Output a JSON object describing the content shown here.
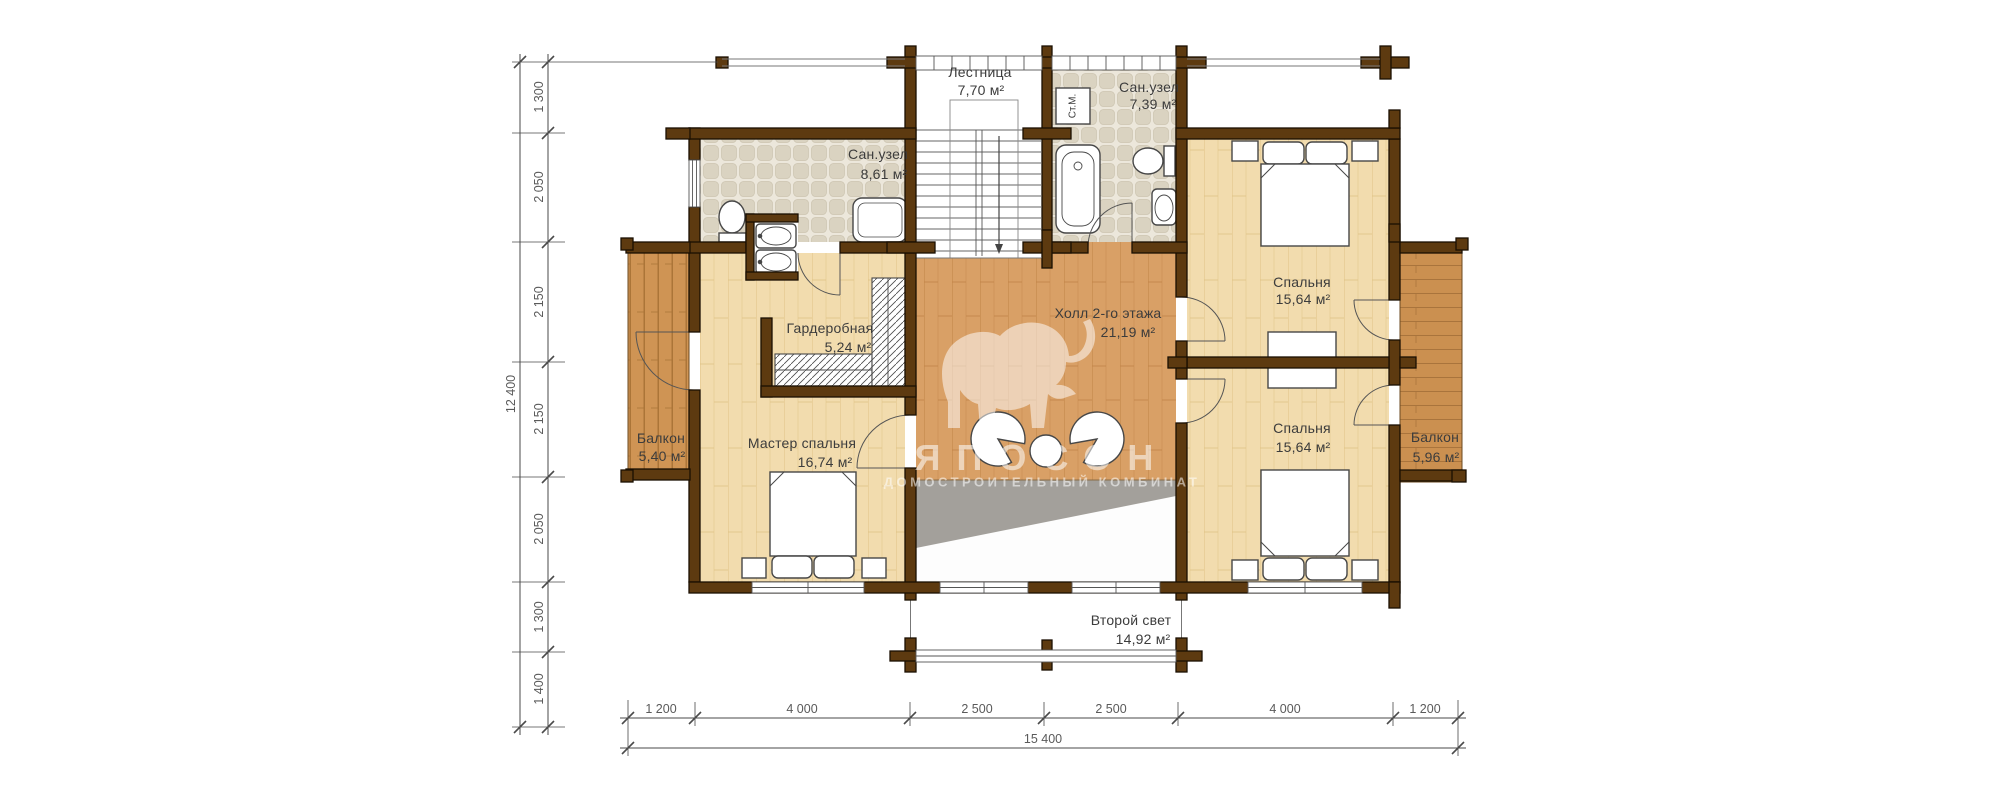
{
  "watermark": {
    "title": "ЯПОСОН",
    "subtitle": "ДОМОСТРОИТЕЛЬНЫЙ КОМБИНАТ"
  },
  "rooms": [
    {
      "id": "staircase",
      "name": "Лестница",
      "area": "7,70 м²"
    },
    {
      "id": "bathroom-top",
      "name": "Сан.узел",
      "area": "7,39 м²"
    },
    {
      "id": "bathroom-left",
      "name": "Сан.узел",
      "area": "8,61 м²"
    },
    {
      "id": "wardrobe",
      "name": "Гардеробная",
      "area": "5,24 м²"
    },
    {
      "id": "hall",
      "name": "Холл 2-го этажа",
      "area": "21,19 м²"
    },
    {
      "id": "bedroom-top",
      "name": "Спальня",
      "area": "15,64 м²"
    },
    {
      "id": "bedroom-bottom",
      "name": "Спальня",
      "area": "15,64 м²"
    },
    {
      "id": "master-bedroom",
      "name": "Мастер спальня",
      "area": "16,74 м²"
    },
    {
      "id": "balcony-left",
      "name": "Балкон",
      "area": "5,40 м²"
    },
    {
      "id": "balcony-right",
      "name": "Балкон",
      "area": "5,96 м²"
    },
    {
      "id": "second-light",
      "name": "Второй свет",
      "area": "14,92 м²"
    }
  ],
  "fixtures": {
    "washing_machine": "Ст.М."
  },
  "dimensions": {
    "left": {
      "segments": [
        "1 300",
        "2 050",
        "2 150",
        "2 150",
        "2 050",
        "1 300",
        "1 400"
      ],
      "total": "12 400"
    },
    "bottom": {
      "segments": [
        "1 200",
        "4 000",
        "2 500",
        "2 500",
        "4 000",
        "1 200"
      ],
      "total": "15 400"
    }
  },
  "colors": {
    "wall": "#5d3a10",
    "wood_light": "#f2dcae",
    "wood_hall": "#d9a066",
    "wood_balcony": "#cb9050",
    "tile": "#e9e4d8",
    "dim_text": "#5a5a5a"
  }
}
